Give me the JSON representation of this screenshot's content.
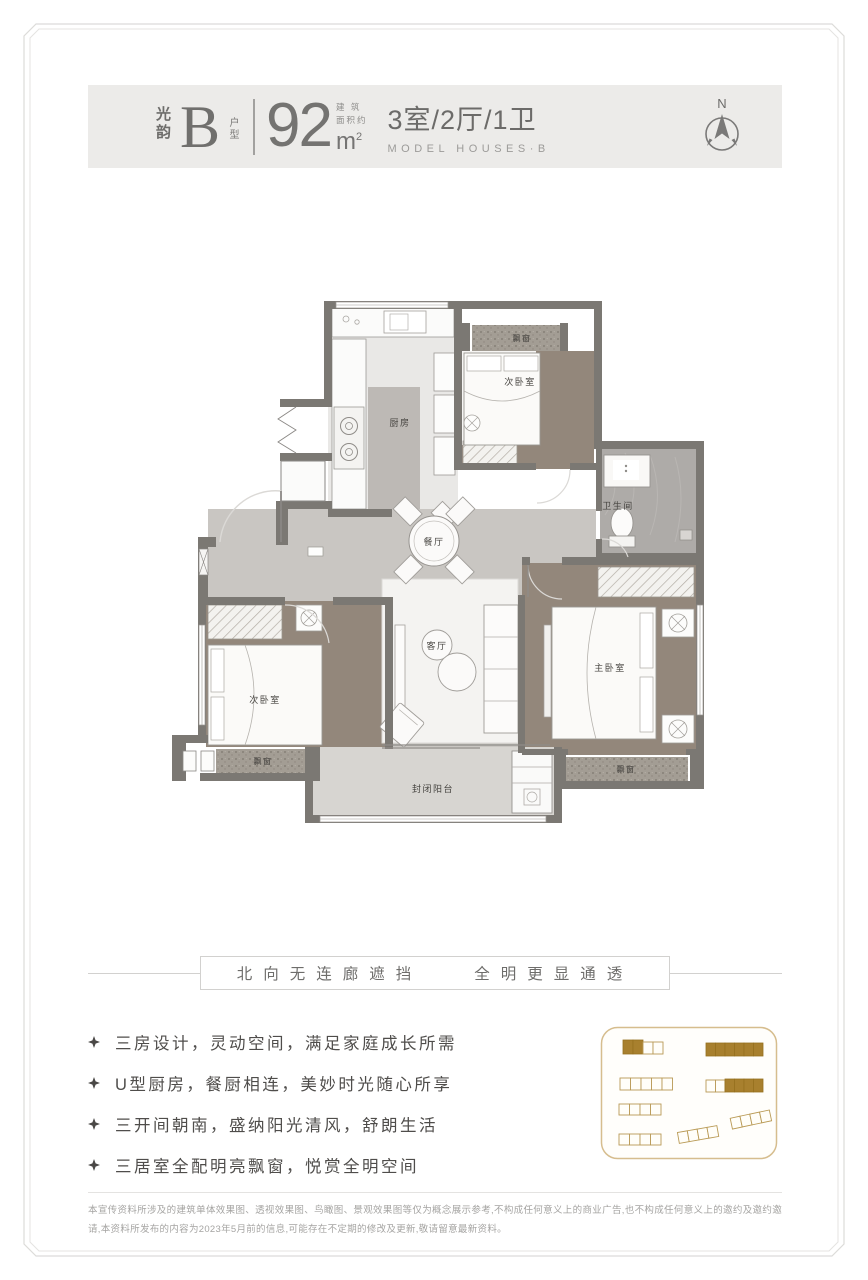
{
  "header": {
    "brand": "光韵",
    "type_letter": "B",
    "type_label": "户型",
    "area_value": "92",
    "area_note_top": "建 筑",
    "area_note_bottom": "面积约",
    "area_unit": "m",
    "area_unit_sup": "2",
    "spec": "3室/2厅/1卫",
    "spec_en": "MODEL HOUSES·B",
    "compass_n": "N"
  },
  "floorplan": {
    "rooms": {
      "kitchen": "厨房",
      "bedroom_top": "次卧室",
      "bathroom": "卫生间",
      "dining": "餐厅",
      "living": "客厅",
      "master": "主卧室",
      "bedroom_left": "次卧室",
      "balcony": "封闭阳台",
      "bay": "飘窗"
    }
  },
  "tagline": {
    "left": "北向无连廊遮挡",
    "right": "全明更显通透"
  },
  "features": [
    "三房设计，灵动空间，满足家庭成长所需",
    "U型厨房，餐厨相连，美妙时光随心所享",
    "三开间朝南，盛纳阳光清风，舒朗生活",
    "三居室全配明亮飘窗，悦赏全明空间"
  ],
  "disclaimer": "本宣传资料所涉及的建筑单体效果图、透视效果图、鸟瞰图、景观效果图等仅为概念展示参考,不构成任何意义上的商业广告,也不构成任何意义上的邀约及邀约邀请,本资料所发布的内容为2023年5月前的信息,可能存在不定期的修改及更新,敬请留意最新资料。",
  "colors": {
    "header_band": "#ecebe9",
    "wall_gray": "#7b7873",
    "floor_gray": "#c9c6c2",
    "bedroom_brown": "#93877b",
    "site_gold_filled": "#a8802e",
    "site_gold_outline": "#b99a55"
  }
}
